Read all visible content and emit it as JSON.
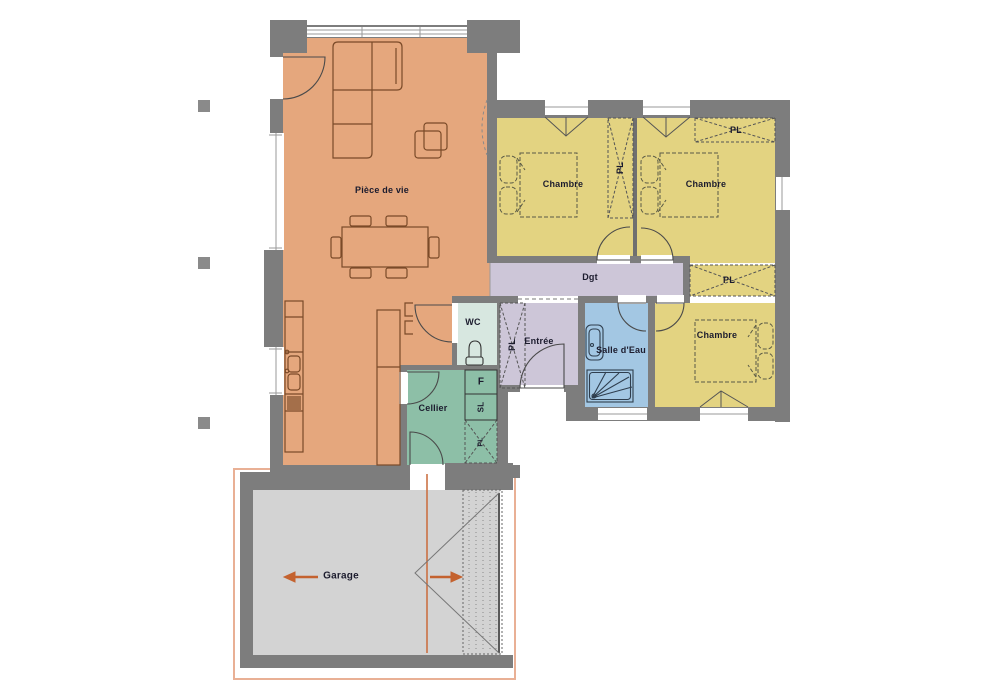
{
  "plan_title": "Plan de maison plain-pied",
  "rooms": {
    "living_room": "Pièce de vie",
    "bedroom_1": "Chambre",
    "bedroom_2": "Chambre",
    "bedroom_3": "Chambre",
    "hallway": "Dgt",
    "wc": "WC",
    "entrance": "Entrée",
    "bathroom": "Salle d'Eau",
    "pantry": "Cellier",
    "garage": "Garage"
  },
  "closet_labels": {
    "closet_bedroom_divider": "PL",
    "closet_bedroom_2": "PL",
    "closet_bedroom_3": "PL",
    "closet_entrance": "PL",
    "closet_pantry": "PL"
  },
  "appliance_labels": {
    "fridge": "F",
    "laundry": "SL"
  },
  "colors": {
    "wall": "#7d7d7d",
    "living_room": "#e5a77d",
    "bedroom": "#e3d381",
    "hallway": "#cdc6d8",
    "wc": "#d7e7e0",
    "bathroom": "#a3c7e3",
    "pantry": "#8dbfa7",
    "garage": "#d3d3d3",
    "garage_outline": "#e9b095",
    "arrow": "#c4622f",
    "furniture_line": "#7a4a28"
  }
}
